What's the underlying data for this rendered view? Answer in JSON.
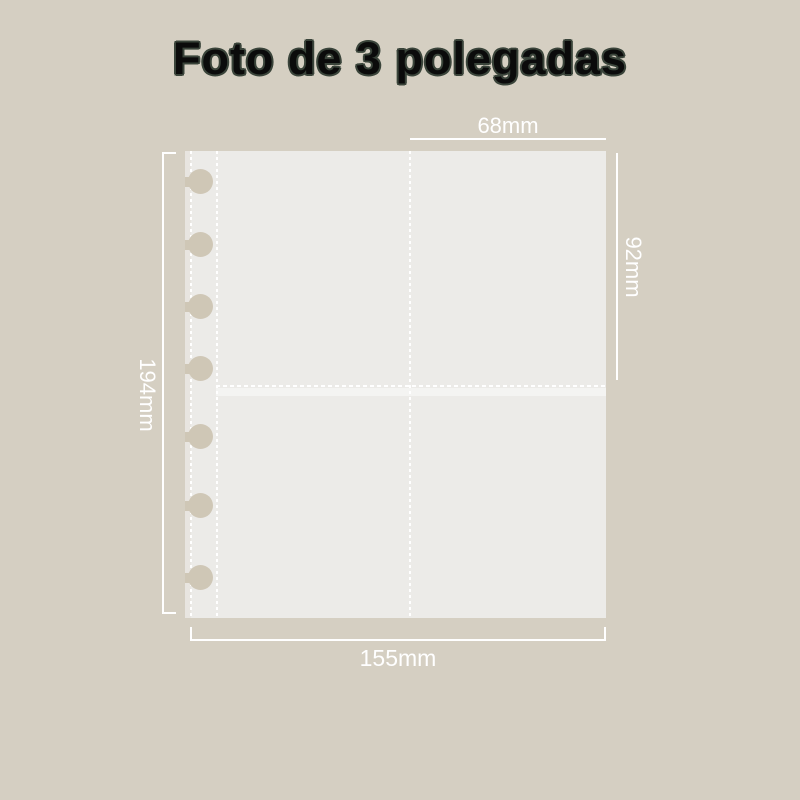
{
  "title": "Foto de 3 polegadas",
  "product": {
    "name": "disc-bound photo album sleeve page",
    "pockets": 4,
    "hole_count": 7
  },
  "dimensions": {
    "pocket_width_top": "68mm",
    "pocket_height_right": "92mm",
    "page_height_left": "194mm",
    "page_width_bottom": "155mm"
  },
  "colors": {
    "background": "#d5cfc2",
    "page": "#ecebe8",
    "binding_strip": "#e8e5e0",
    "hole": "#cfc7b6",
    "seam_dots": "#ffffff",
    "annotation": "#ffffff",
    "title_fill": "#0b0b0b",
    "title_outline": "#3a443a"
  }
}
